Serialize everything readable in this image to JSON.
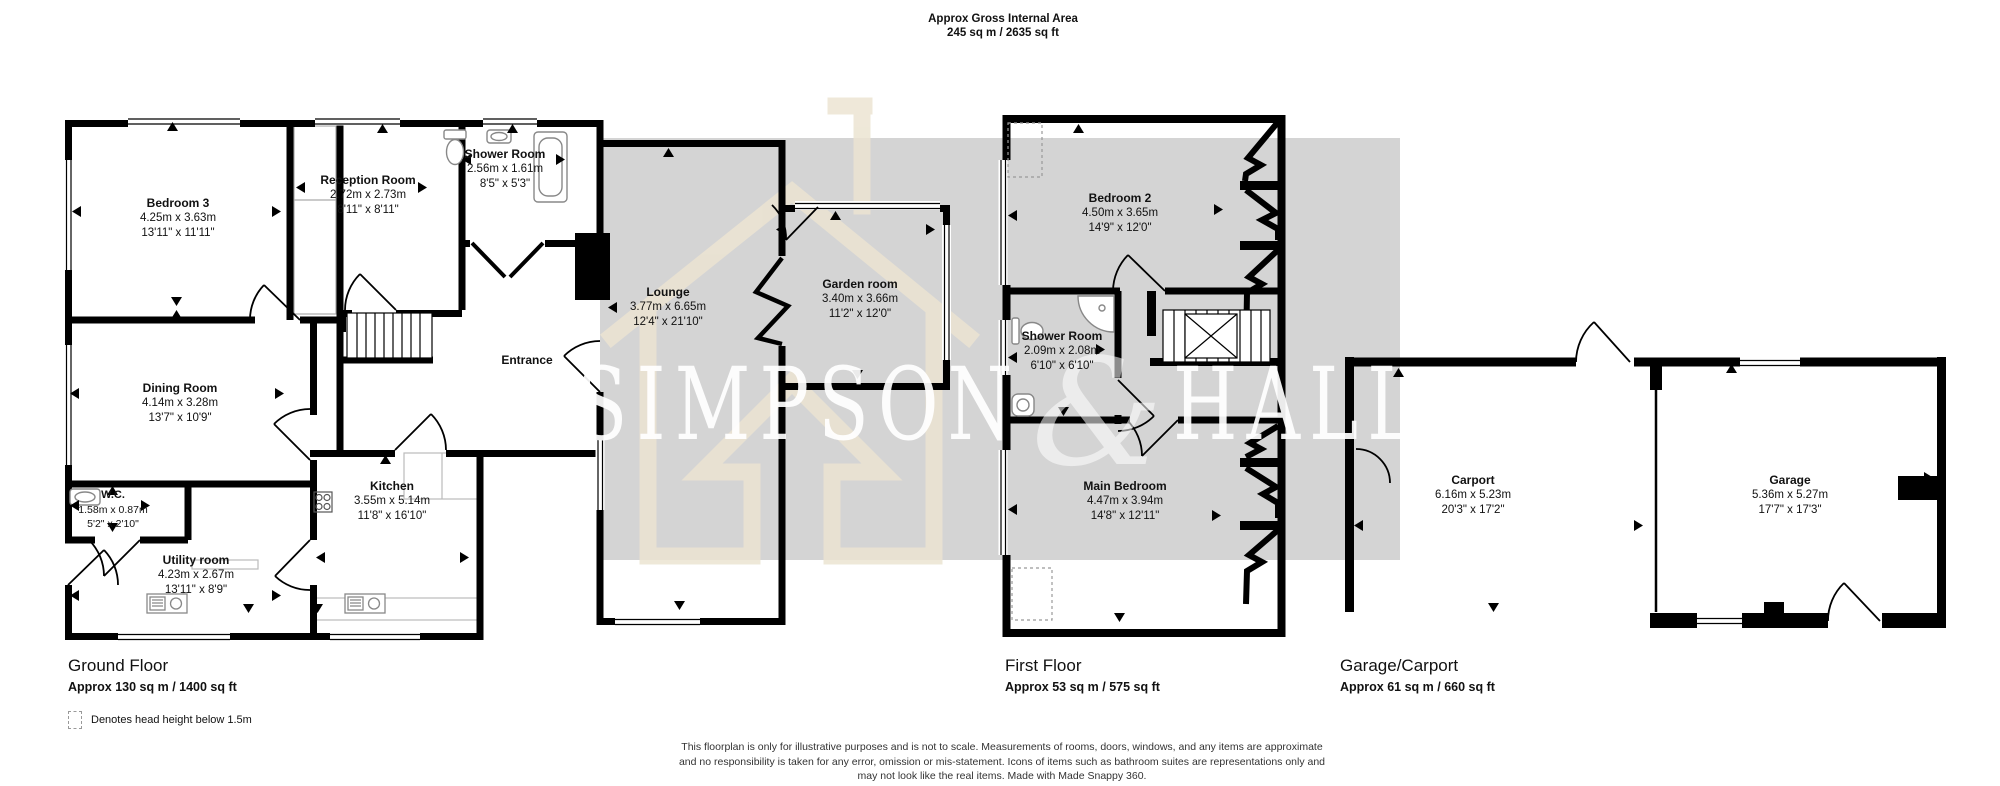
{
  "title": {
    "line1": "Approx Gross Internal Area",
    "line2": "245 sq m / 2635 sq ft"
  },
  "watermark": {
    "brand_left": "SIMPSON",
    "brand_amp": "&",
    "brand_right": "HALL"
  },
  "rooms": {
    "bedroom3": {
      "name": "Bedroom 3",
      "metric": "4.25m x 3.63m",
      "imperial": "13'11\" x 11'11\""
    },
    "reception": {
      "name": "Reception Room",
      "metric": "2.72m x 2.73m",
      "imperial": "8'11\" x 8'11\""
    },
    "shower_gf": {
      "name": "Shower Room",
      "metric": "2.56m x 1.61m",
      "imperial": "8'5\" x 5'3\""
    },
    "dining": {
      "name": "Dining Room",
      "metric": "4.14m x 3.28m",
      "imperial": "13'7\" x 10'9\""
    },
    "wc": {
      "name": "W.C.",
      "metric": "1.58m x 0.87m",
      "imperial": "5'2\" x 2'10\""
    },
    "utility": {
      "name": "Utility room",
      "metric": "4.23m x 2.67m",
      "imperial": "13'11\" x 8'9\""
    },
    "kitchen": {
      "name": "Kitchen",
      "metric": "3.55m x 5.14m",
      "imperial": "11'8\" x 16'10\""
    },
    "entrance": {
      "name": "Entrance"
    },
    "lounge": {
      "name": "Lounge",
      "metric": "3.77m x 6.65m",
      "imperial": "12'4\" x 21'10\""
    },
    "garden": {
      "name": "Garden room",
      "metric": "3.40m x 3.66m",
      "imperial": "11'2\" x 12'0\""
    },
    "bedroom2": {
      "name": "Bedroom 2",
      "metric": "4.50m x 3.65m",
      "imperial": "14'9\" x 12'0\""
    },
    "shower_ff": {
      "name": "Shower Room",
      "metric": "2.09m x 2.08m",
      "imperial": "6'10\" x 6'10\""
    },
    "main_bedroom": {
      "name": "Main Bedroom",
      "metric": "4.47m x 3.94m",
      "imperial": "14'8\" x 12'11\""
    },
    "carport": {
      "name": "Carport",
      "metric": "6.16m x 5.23m",
      "imperial": "20'3\" x 17'2\""
    },
    "garage": {
      "name": "Garage",
      "metric": "5.36m x 5.27m",
      "imperial": "17'7\" x 17'3\""
    }
  },
  "floors": {
    "ground": {
      "label": "Ground Floor",
      "area": "Approx 130 sq m / 1400 sq ft"
    },
    "first": {
      "label": "First Floor",
      "area": "Approx 53 sq m / 575 sq ft"
    },
    "garage": {
      "label": "Garage/Carport",
      "area": "Approx 61 sq m / 660 sq ft"
    }
  },
  "legend": {
    "text": "Denotes head height below 1.5m"
  },
  "disclaimer": {
    "line1": "This floorplan is only for illustrative purposes and is not to scale. Measurements of rooms, doors, windows, and any items are approximate",
    "line2": "and no responsibility is taken for any error, omission or mis-statement. Icons of items such as bathroom suites are representations only and",
    "line3": "may not look like the real items. Made with Made Snappy 360."
  },
  "colors": {
    "wall": "#000000",
    "watermark_gray": "#d4d4d4",
    "watermark_cream": "#ece4d2"
  }
}
